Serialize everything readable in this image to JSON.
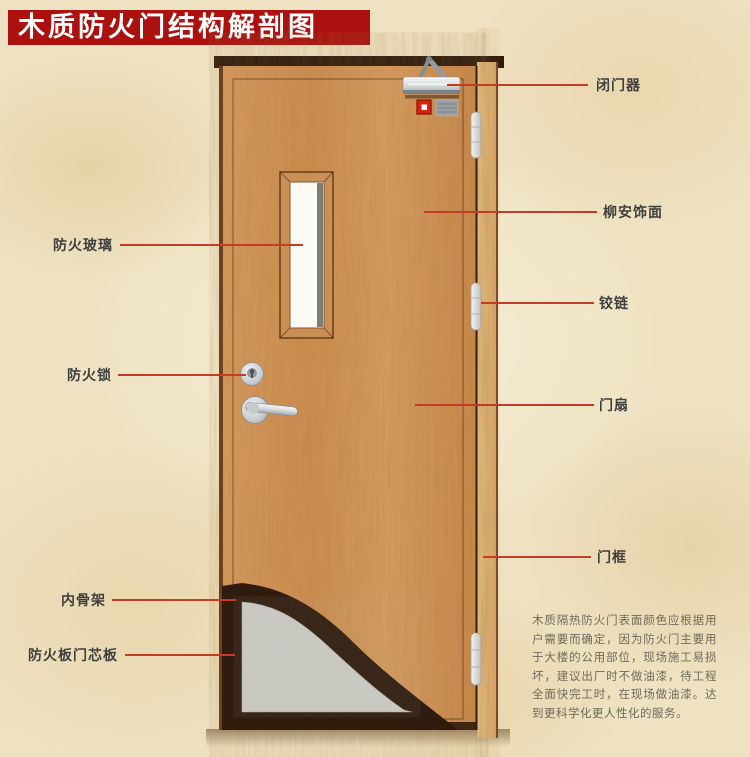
{
  "title": {
    "text": "木质防火门结构解剖图"
  },
  "labels": {
    "left": [
      {
        "id": "fire-glass",
        "text": "防火玻璃"
      },
      {
        "id": "fire-lock",
        "text": "防火锁"
      },
      {
        "id": "inner-skeleton",
        "text": "内骨架"
      },
      {
        "id": "fire-board-core",
        "text": "防火板门芯板"
      }
    ],
    "right": [
      {
        "id": "door-closer",
        "text": "闭门器"
      },
      {
        "id": "lauan-veneer",
        "text": "柳安饰面"
      },
      {
        "id": "hinge",
        "text": "铰链"
      },
      {
        "id": "door-leaf",
        "text": "门扇"
      },
      {
        "id": "door-frame",
        "text": "门框"
      }
    ]
  },
  "description": {
    "text": "木质隔热防火门表面颜色应根据用户需要而确定，因为防火门主要用于大楼的公用部位，现场施工易损坏，建议出厂时不做油漆，待工程全面快完工时，在现场做油漆。达到更科学化更人性化的服务。"
  },
  "colors": {
    "banner": "#ac1110",
    "leader_line": "#c43b26",
    "door_wood": "#d2954f",
    "frame_wood": "#dfb077",
    "core_panel": "#cbcac3",
    "skeleton": "#2f1c0e",
    "alarm_red": "#d92312"
  }
}
